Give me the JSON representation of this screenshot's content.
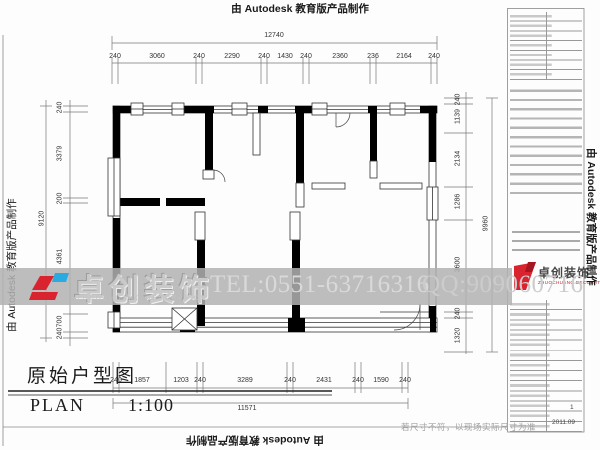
{
  "watermark": {
    "autodesk": "由 Autodesk 教育版产品制作",
    "brand_cn": "卓创装饰",
    "brand_en": "ZHUOCHUANG DECORATION",
    "tel": "TEL:0551-63716316",
    "qq": "QQ:909060716"
  },
  "plan_title": {
    "cn": "原始户型图",
    "label": "PLAN",
    "scale": "1:100"
  },
  "note": "若尺寸不符，以现场实际尺寸为准",
  "title_block": {
    "sheet_no": "1",
    "date": "2011.09"
  },
  "dimensions": {
    "top": {
      "total": "12740",
      "segments": [
        "240",
        "3060",
        "240",
        "2290",
        "240",
        "1430",
        "240",
        "2360",
        "236",
        "2164",
        "240"
      ]
    },
    "bottom": {
      "total": "11571",
      "segments": [
        "240",
        "1857",
        "1203",
        "240",
        "3289",
        "240",
        "2431",
        "240",
        "1590",
        "240"
      ]
    },
    "left": {
      "total": "9120",
      "segments": [
        "240",
        "3379",
        "200",
        "4361",
        "700",
        "240"
      ]
    },
    "right": {
      "total": "9960",
      "segments": [
        "240",
        "1139",
        "2134",
        "1286",
        "3600",
        "240",
        "1320"
      ]
    }
  },
  "colors": {
    "wall": "#000000",
    "band_gray": "#b5b5b5",
    "logo_red": "#d9232e",
    "logo_blue": "#29abe2"
  }
}
